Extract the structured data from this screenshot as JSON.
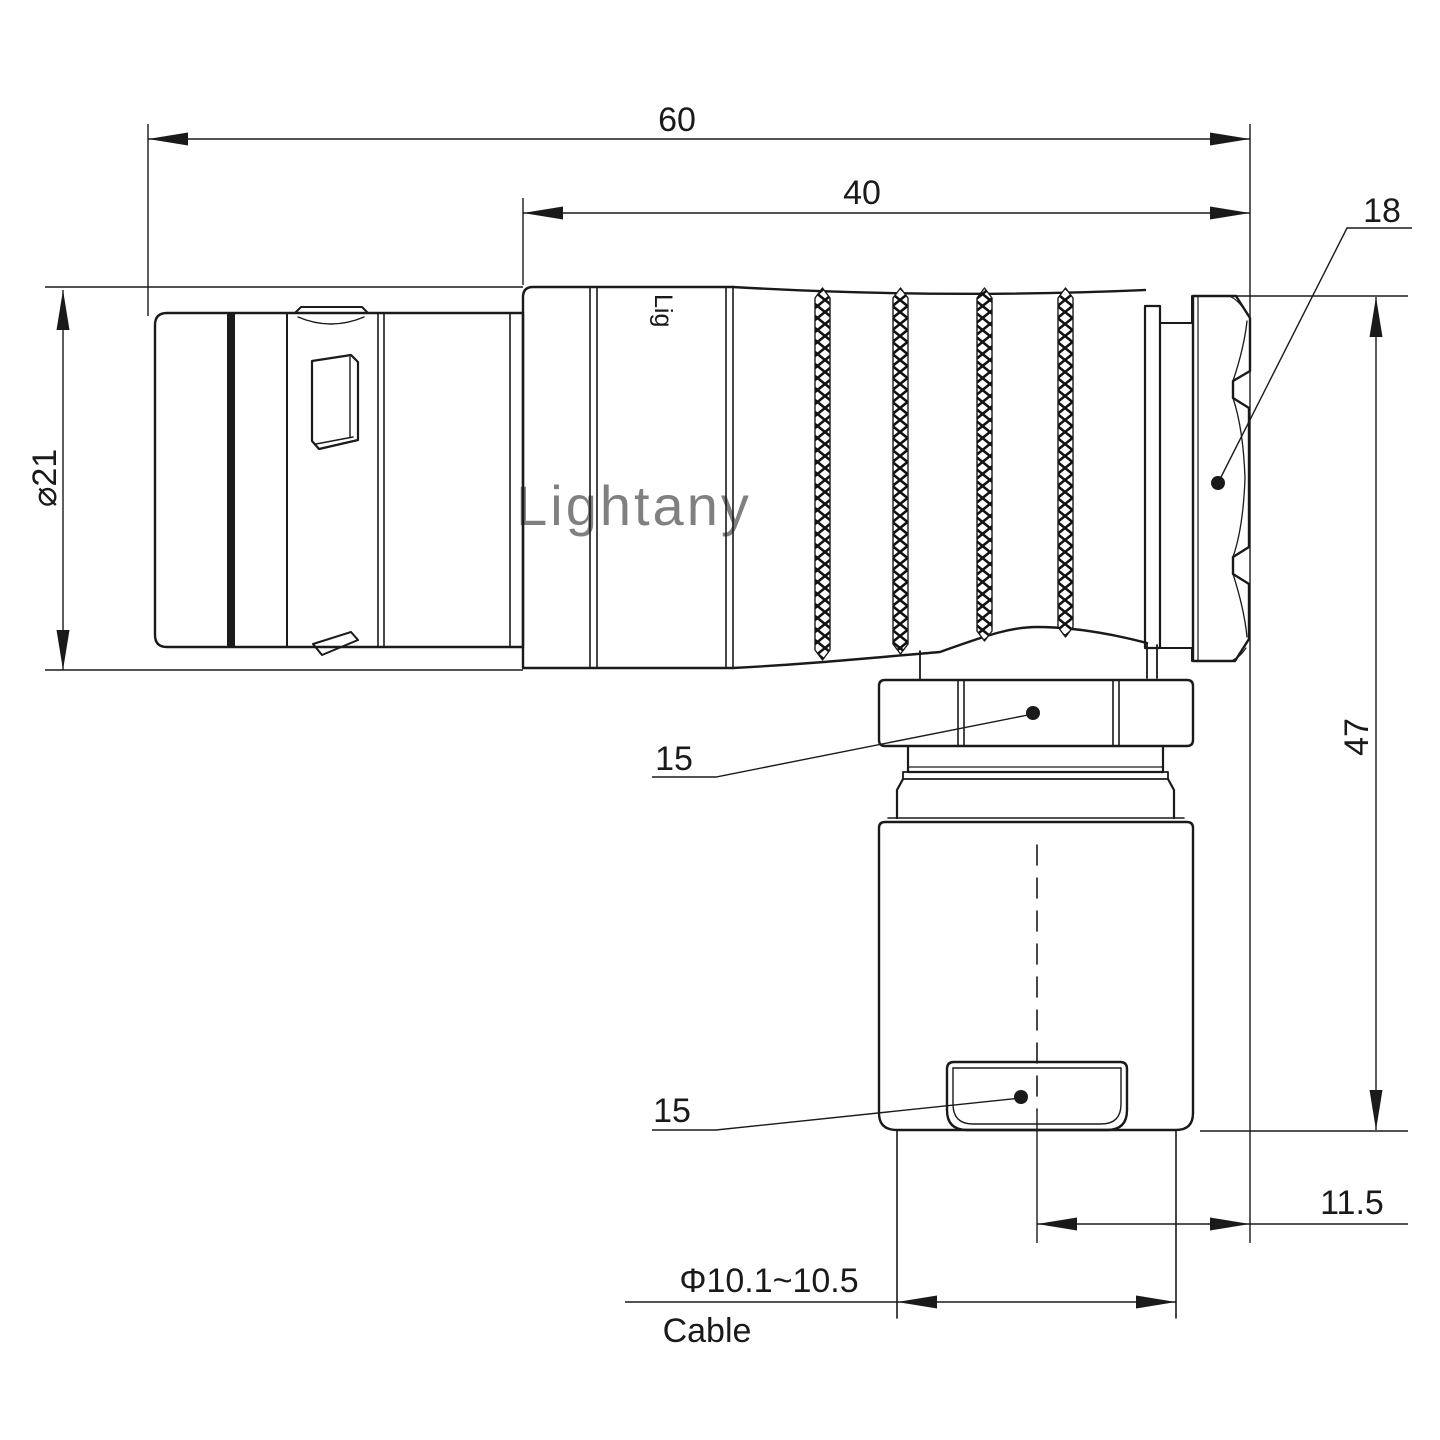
{
  "drawing": {
    "title": "right-angle-connector-dimension-drawing",
    "colors": {
      "line": "#1a1a1a",
      "background": "#ffffff",
      "watermark_pink": "#f5c9c9"
    },
    "watermark": {
      "text": "Lightany"
    },
    "body_print": {
      "text": "Lig"
    },
    "dimensions": {
      "total_length": "60",
      "body_length": "40",
      "nut_across_flats": "18",
      "shell_diameter": "⌀21",
      "total_height": "47",
      "back_hex": "15",
      "clamp_width": "15",
      "axis_offset": "11.5",
      "cable_diameter_range": "Φ10.1~10.5",
      "cable_word": "Cable"
    }
  }
}
